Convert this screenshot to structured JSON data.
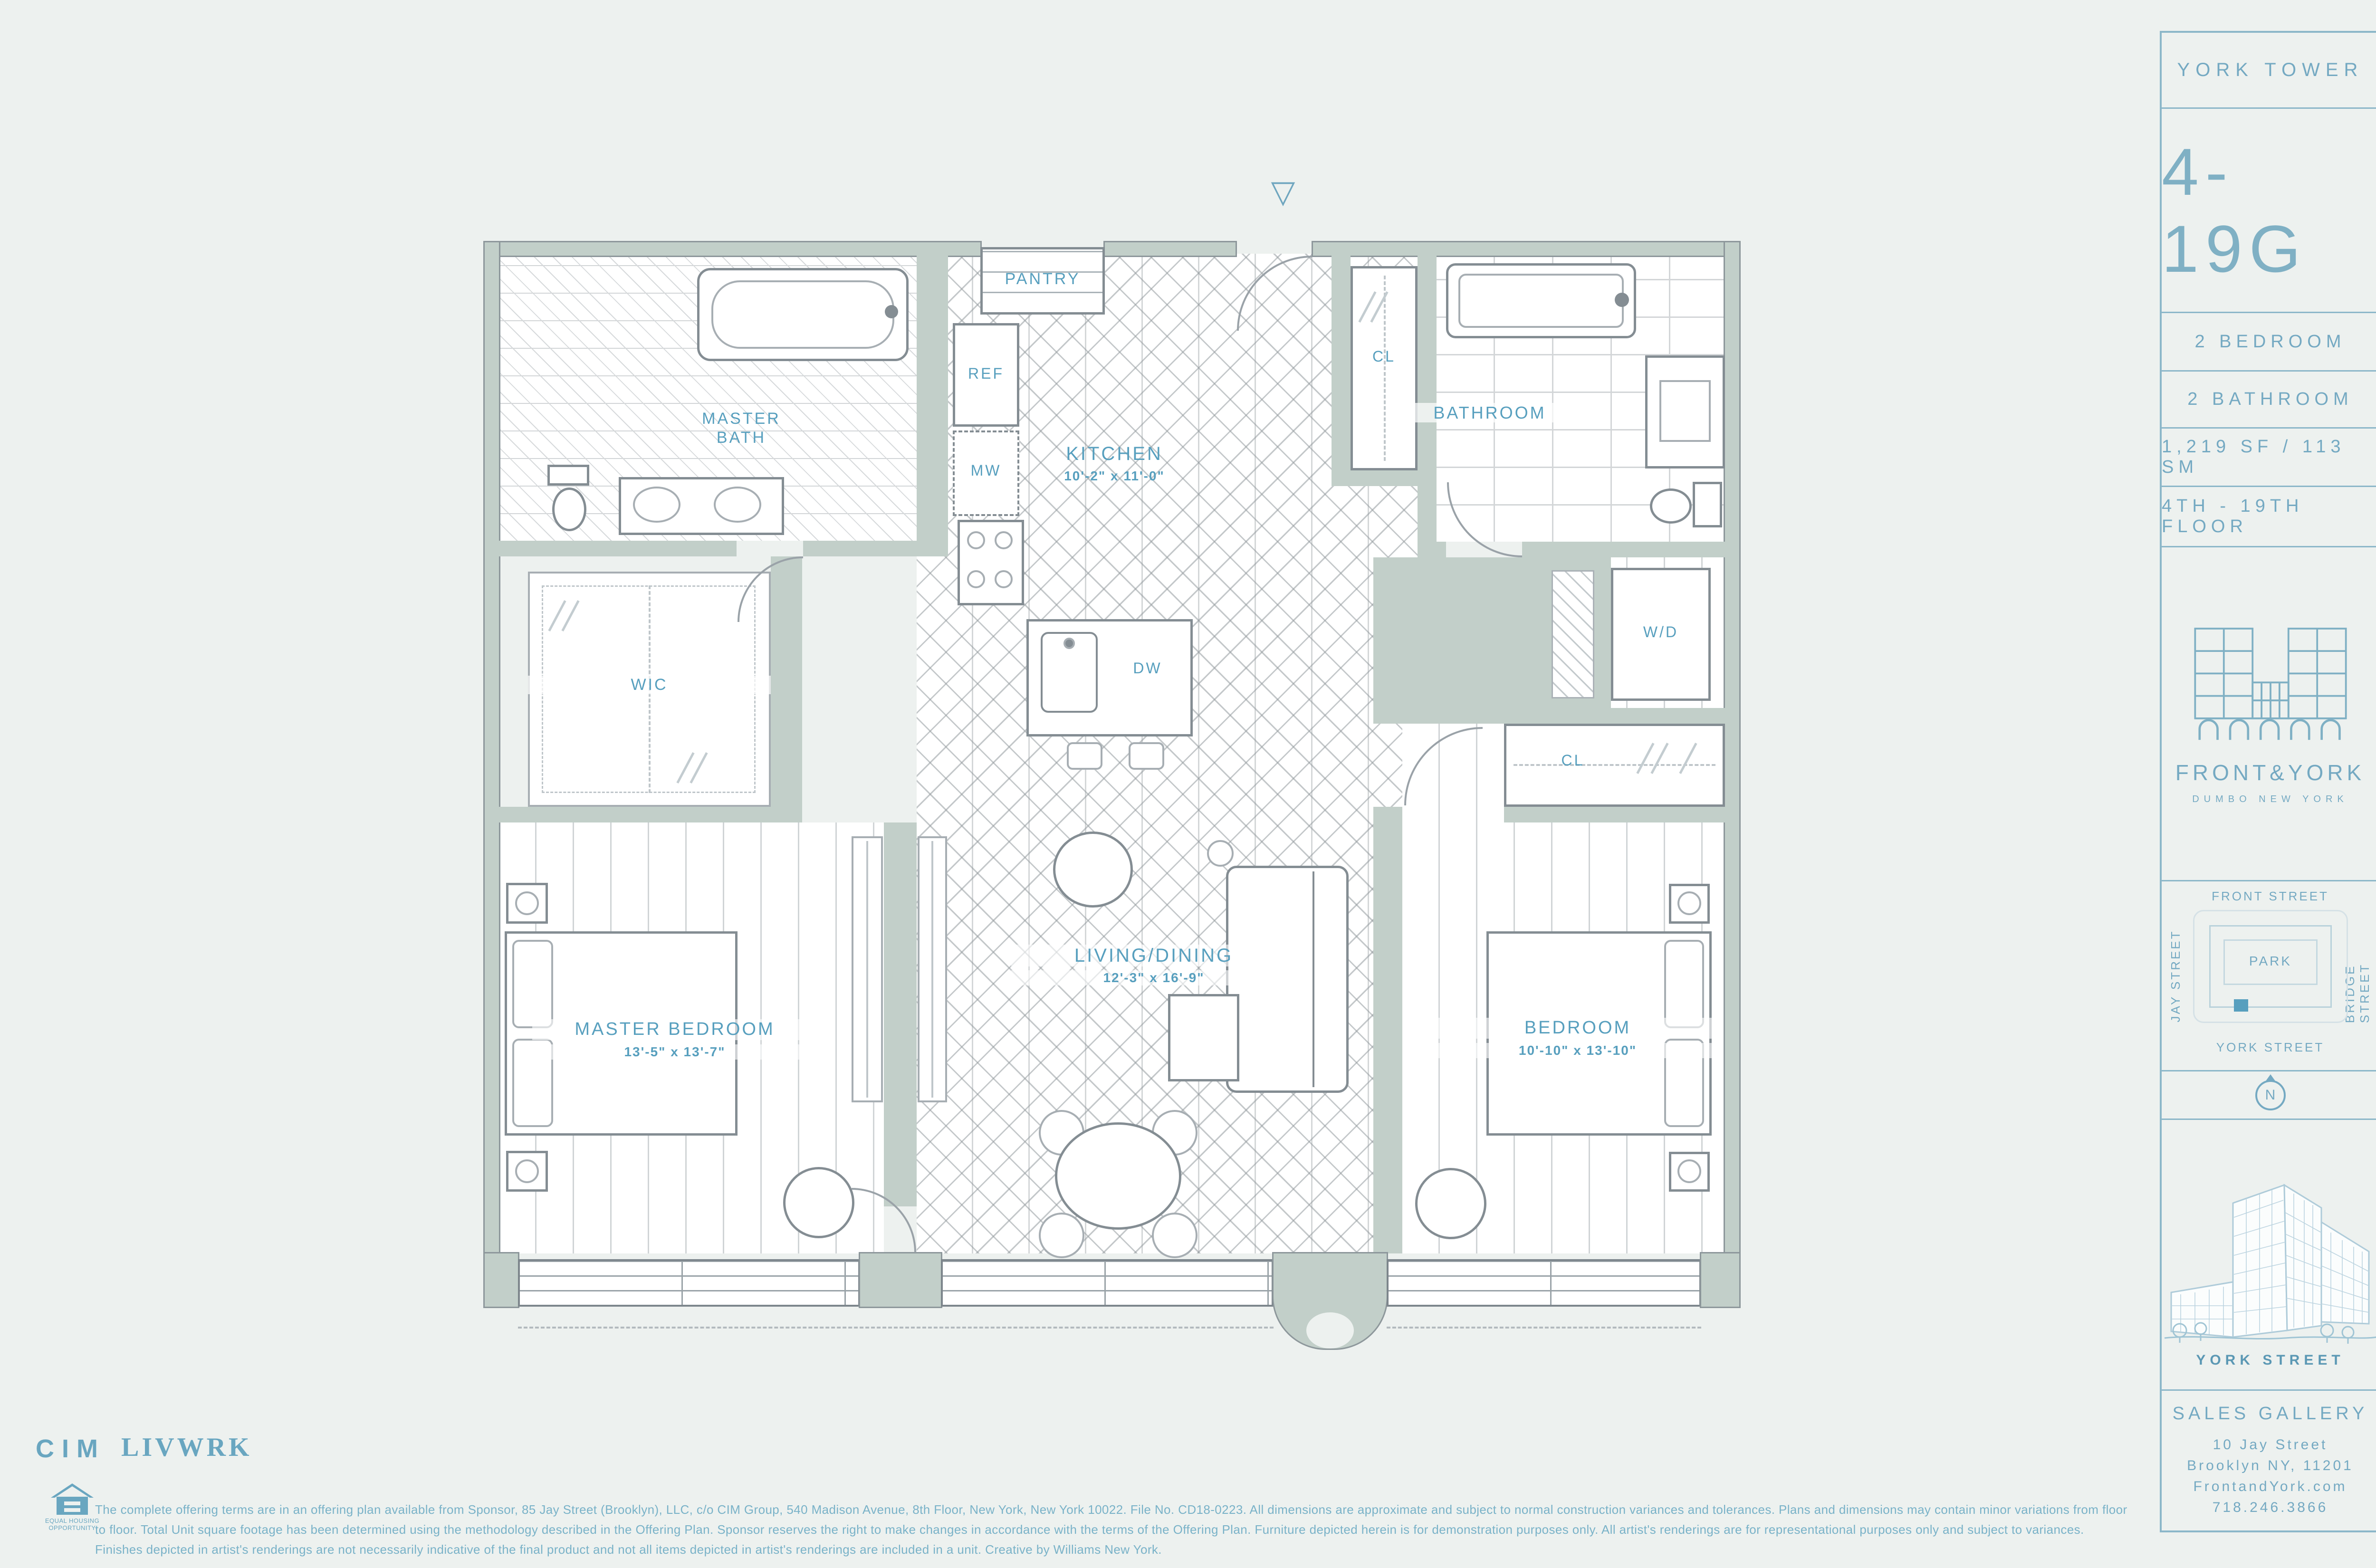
{
  "colors": {
    "accent": "#579fbe",
    "sidebar_text": "#74a9c2",
    "wall": "#c2cfc9",
    "background": "#edf1ef"
  },
  "sidebar": {
    "tower_name": "YORK TOWER",
    "unit_number": "4-19G",
    "spec_bedroom": "2 BEDROOM",
    "spec_bathroom": "2 BATHROOM",
    "spec_area": "1,219 SF / 113 SM",
    "spec_floors": "4TH - 19TH FLOOR",
    "brand_name": "FRONT&YORK",
    "brand_tagline": "DUMBO NEW YORK",
    "map_front": "FRONT STREET",
    "map_jay": "JAY STREET",
    "map_bridge": "BRIDGE STREET",
    "map_york": "YORK STREET",
    "map_park": "PARK",
    "compass_n": "N",
    "rendering_caption": "YORK STREET",
    "sales_title": "SALES GALLERY",
    "sales_address1": "10 Jay Street",
    "sales_address2": "Brooklyn NY, 11201",
    "sales_website": "FrontandYork.com",
    "sales_phone": "718.246.3866"
  },
  "plan": {
    "entry_marker": "▽",
    "master_bath_1": "MASTER",
    "master_bath_2": "BATH",
    "wic": "WIC",
    "master_bedroom": "MASTER BEDROOM",
    "master_bedroom_dims": "13'-5\" x 13'-7\"",
    "kitchen": "KITCHEN",
    "kitchen_dims": "10'-2\" x 11'-0\"",
    "living": "LIVING/DINING",
    "living_dims": "12'-3\" x 16'-9\"",
    "bedroom": "BEDROOM",
    "bedroom_dims": "10'-10\" x 13'-10\"",
    "bathroom": "BATHROOM",
    "pantry": "PANTRY",
    "ref": "REF",
    "mw": "MW",
    "dw": "DW",
    "wd": "W/D",
    "cl_hall": "CL",
    "cl_bedroom": "CL"
  },
  "footer": {
    "logo_cim": "CIM",
    "logo_livwrk": "LIVWRK",
    "eho_line1": "EQUAL HOUSING",
    "eho_line2": "OPPORTUNITY",
    "disclaimer_line1": "The complete offering terms are in an offering plan available from Sponsor, 85 Jay Street (Brooklyn), LLC, c/o CIM Group, 540 Madison Avenue, 8th Floor, New York, New York 10022.  File No. CD18-0223. All dimensions are approximate and subject to normal construction variances and tolerances.  Plans and dimensions may contain minor variations from floor",
    "disclaimer_line2": "to floor.  Total Unit square footage has been determined using the methodology described in the Offering Plan.  Sponsor reserves the right to make changes in accordance with the terms of the Offering Plan. Furniture depicted herein is for demonstration purposes only. All artist's renderings are for representational purposes only and subject to variances.",
    "disclaimer_line3": "Finishes depicted in artist's renderings are not necessarily indicative of the final product and not all items depicted in artist's renderings are included in a unit. Creative by Williams New York."
  }
}
